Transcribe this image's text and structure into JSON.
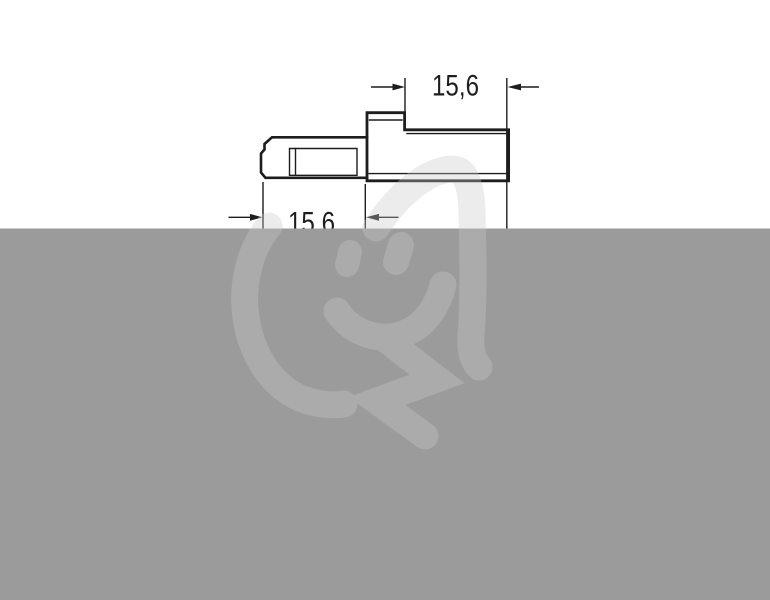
{
  "page": {
    "background": "#ffffff"
  },
  "drawing": {
    "type": "technical-side-view",
    "subject": "connector-housing-profile",
    "line_color": "#1d1d1d",
    "dimensions": [
      {
        "id": "top",
        "label": "15,6"
      },
      {
        "id": "bottom",
        "label": "15,6"
      }
    ]
  },
  "overlay": {
    "color": "#9b9b9b"
  },
  "watermark": {
    "name": "plug-smiley-logo",
    "color": "rgba(201,201,201,0.35)"
  }
}
